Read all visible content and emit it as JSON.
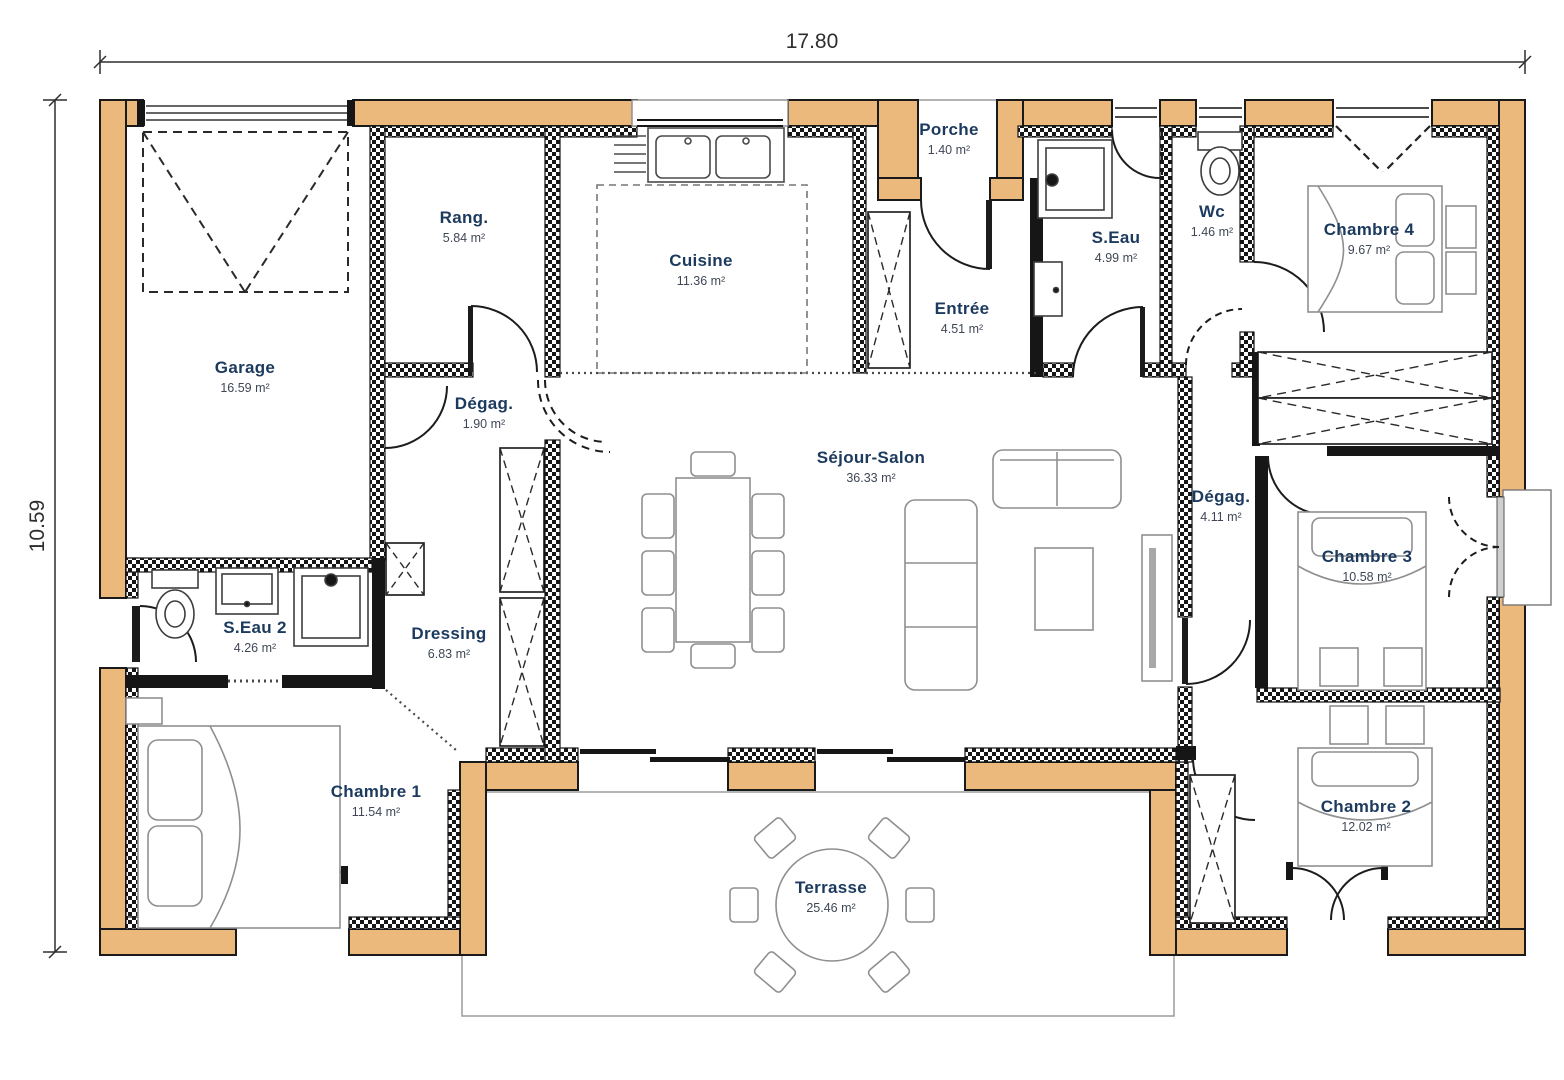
{
  "plan": {
    "type": "floor-plan",
    "dimensions": {
      "width_label": "17.80",
      "height_label": "10.59"
    },
    "rooms": [
      {
        "name": "Garage",
        "area": "16.59 m²"
      },
      {
        "name": "Rang.",
        "area": "5.84 m²"
      },
      {
        "name": "Cuisine",
        "area": "11.36 m²"
      },
      {
        "name": "Porche",
        "area": "1.40 m²"
      },
      {
        "name": "Entrée",
        "area": "4.51 m²"
      },
      {
        "name": "S.Eau",
        "area": "4.99 m²"
      },
      {
        "name": "Wc",
        "area": "1.46 m²"
      },
      {
        "name": "Chambre 4",
        "area": "9.67 m²"
      },
      {
        "name": "Dégag.",
        "area": "1.90 m²"
      },
      {
        "name": "Séjour-Salon",
        "area": "36.33 m²"
      },
      {
        "name": "Dégag.",
        "area": "4.11 m²"
      },
      {
        "name": "Chambre 3",
        "area": "10.58 m²"
      },
      {
        "name": "S.Eau 2",
        "area": "4.26 m²"
      },
      {
        "name": "Dressing",
        "area": "6.83 m²"
      },
      {
        "name": "Chambre 1",
        "area": "11.54 m²"
      },
      {
        "name": "Chambre 2",
        "area": "12.02 m²"
      },
      {
        "name": "Terrasse",
        "area": "25.46 m²"
      }
    ],
    "colors": {
      "exterior_wall": "#ECB97D",
      "wall": "#161616",
      "room_name_text": "#1C3A5E",
      "area_text": "#3F4756",
      "furniture_line": "#8F8F8F"
    }
  }
}
